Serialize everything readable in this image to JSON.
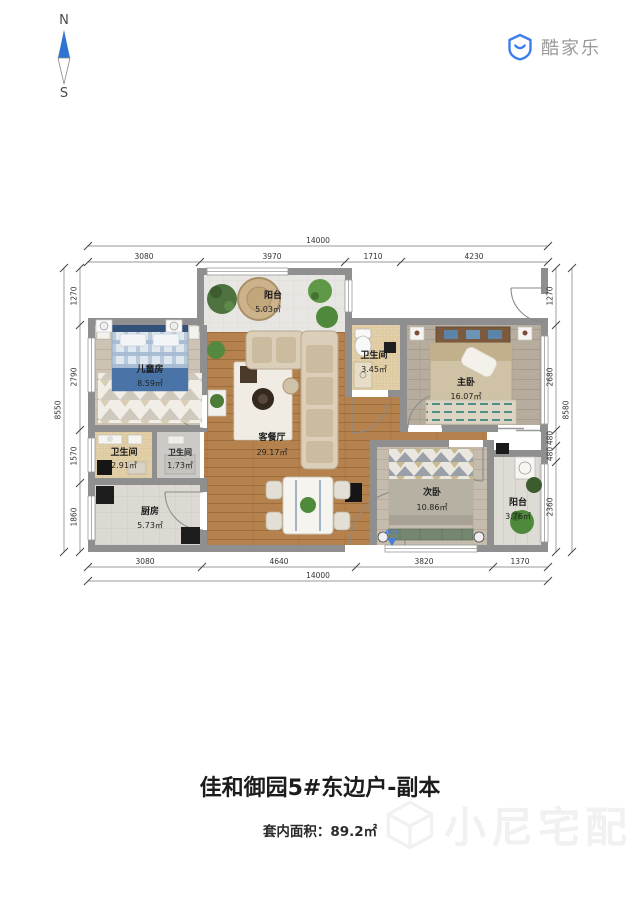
{
  "compass": {
    "north": "N",
    "south": "S"
  },
  "logo": {
    "brand": "酷家乐"
  },
  "plan": {
    "rooms": [
      {
        "name": "阳台",
        "area": "5.03㎡"
      },
      {
        "name": "儿童房",
        "area": "8.59㎡"
      },
      {
        "name": "卫生间",
        "area": "3.45㎡"
      },
      {
        "name": "主卧",
        "area": "16.07㎡"
      },
      {
        "name": "卫生间",
        "area": "2.91㎡"
      },
      {
        "name": "卫生间",
        "area": "1.73㎡"
      },
      {
        "name": "厨房",
        "area": "5.73㎡"
      },
      {
        "name": "客餐厅",
        "area": "29.17㎡"
      },
      {
        "name": "次卧",
        "area": "10.86㎡"
      },
      {
        "name": "阳台",
        "area": "3.76㎡"
      }
    ],
    "entry_label": "A02",
    "dimensions": {
      "top": {
        "overall": "14000",
        "segments": [
          "3080",
          "3970",
          "1710",
          "4230"
        ]
      },
      "bottom": {
        "overall": "14000",
        "segments": [
          "3080",
          "4640",
          "3820",
          "1370"
        ]
      },
      "left": {
        "overall": "8550",
        "segments": [
          "1270",
          "2790",
          "1570",
          "1860"
        ]
      },
      "right": {
        "overall": "8580",
        "segments": [
          "1270",
          "2680",
          "480",
          "480",
          "2360"
        ]
      }
    }
  },
  "footer": {
    "title": "佳和御园5#东边户-副本",
    "area_text": "套内面积：89.2㎡",
    "watermark": "小尼宅配"
  },
  "colors": {
    "accent_blue": "#3d7fe8",
    "wall_gray": "#8f8f8f"
  }
}
